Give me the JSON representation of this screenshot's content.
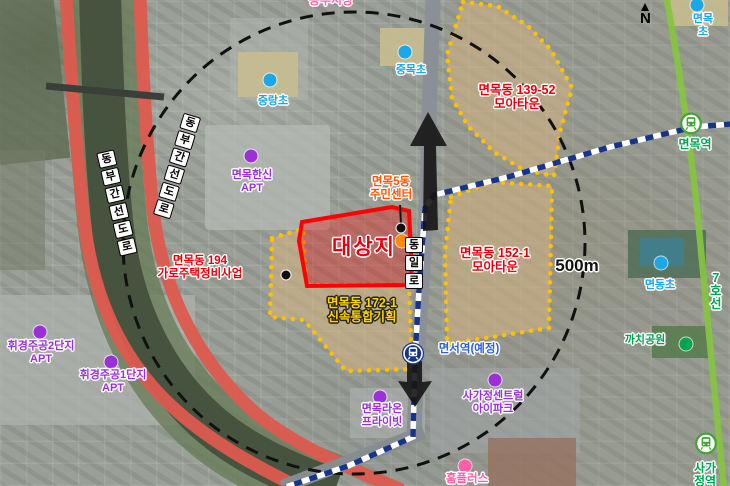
{
  "compass": "N",
  "scale": "500m",
  "site": {
    "label": "대상지"
  },
  "zones": {
    "z139": {
      "label": "면목동 139-52\n모아타운"
    },
    "z152": {
      "label": "면목동 152-1\n모아타운"
    },
    "z172": {
      "label": "면목동 172-1\n신속통합기획"
    },
    "z194": {
      "label": "면목동 194\n가로주택정비사업"
    }
  },
  "roads": {
    "dongil": "동일로",
    "dongbu": "동부간선도로",
    "line7": "7호선"
  },
  "stations": {
    "myeonmok": "면목역",
    "sagajeong": "사가정역",
    "myeonseo": "면서역(예정)"
  },
  "schools": {
    "jungnang": "중랑초",
    "jungmok": "중목초",
    "myeonmok": "면목초",
    "myeondong": "면동초"
  },
  "places": {
    "dongbu_market": "동부시장",
    "homeplus": "홈플러스",
    "kkachi_park": "까치공원",
    "jumin_center": "면목5동\n주민센터",
    "hanshin_apt": "면목한신\nAPT",
    "hwigyeong2_apt": "휘경주공2단지\nAPT",
    "hwigyeong1_apt": "휘경주공1단지\nAPT",
    "raon_apt": "면목라온\n프라이빗",
    "sagajeong_central_apt": "사가정센트럴\n아이파크"
  },
  "colors": {
    "zone_border": "#FFC000",
    "zone_fill": "rgba(215,180,130,0.55)",
    "site_border": "#FF0000",
    "label_red": "#E8000D",
    "highlight_yellow": "#FFD400",
    "school_blue": "#1BA7E8",
    "apt_purple": "#9B30D9",
    "green": "#00A651",
    "pink": "#FF5FA6",
    "orange": "#FF8C00",
    "line7_green": "#85C441",
    "myeonmok_line_navy": "#16348C",
    "expressway_red": "#DD5A4E"
  }
}
